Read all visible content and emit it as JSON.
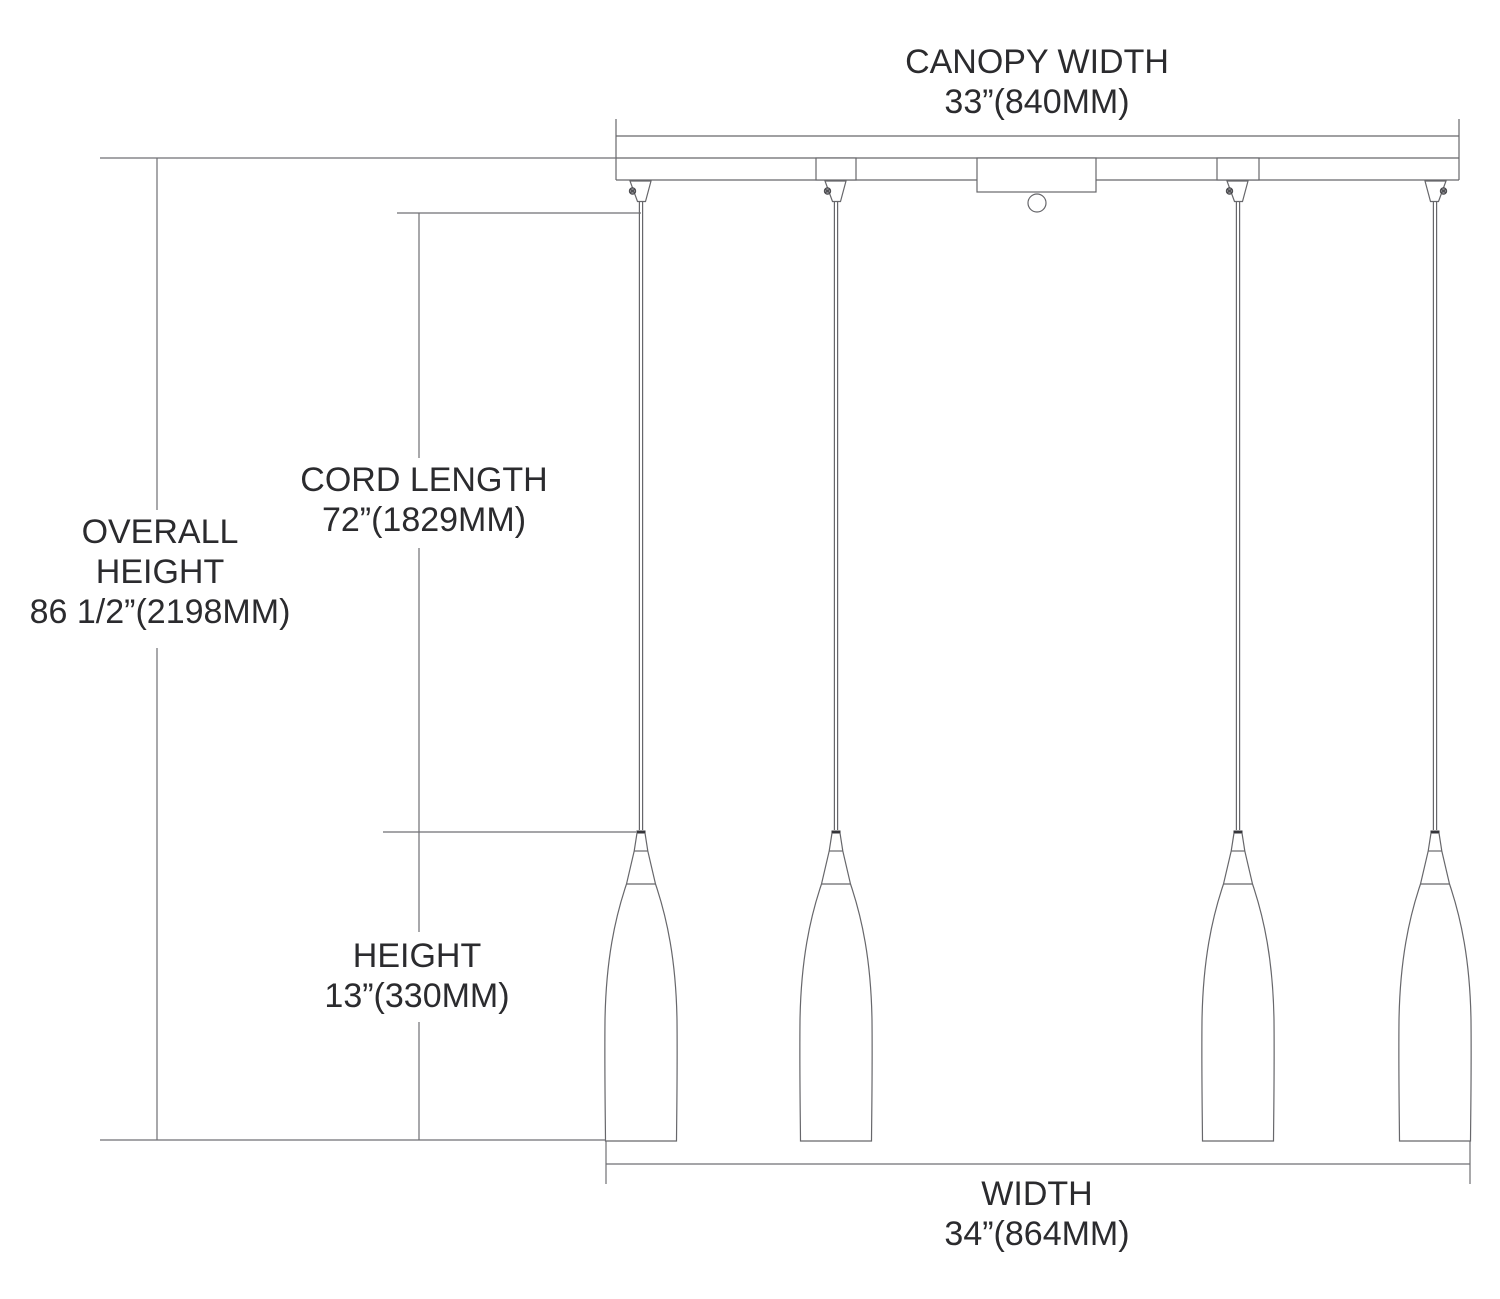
{
  "diagram_type": "pendant-light-fixture-dimension-drawing",
  "fixture": {
    "pendant_count": 4
  },
  "labels": {
    "canopy_width": {
      "name": "CANOPY WIDTH",
      "value": "33”(840MM)"
    },
    "overall_height": {
      "line1": "OVERALL",
      "line2": "HEIGHT",
      "value": "86 1/2”(2198MM)"
    },
    "cord_length": {
      "name": "CORD LENGTH",
      "value": "72”(1829MM)"
    },
    "shade_height": {
      "name": "HEIGHT",
      "value": "13”(330MM)"
    },
    "width": {
      "name": "WIDTH",
      "value": "34”(864MM)"
    }
  },
  "colors": {
    "line": "#67676b",
    "text": "#2b2b2e",
    "background": "#ffffff"
  }
}
